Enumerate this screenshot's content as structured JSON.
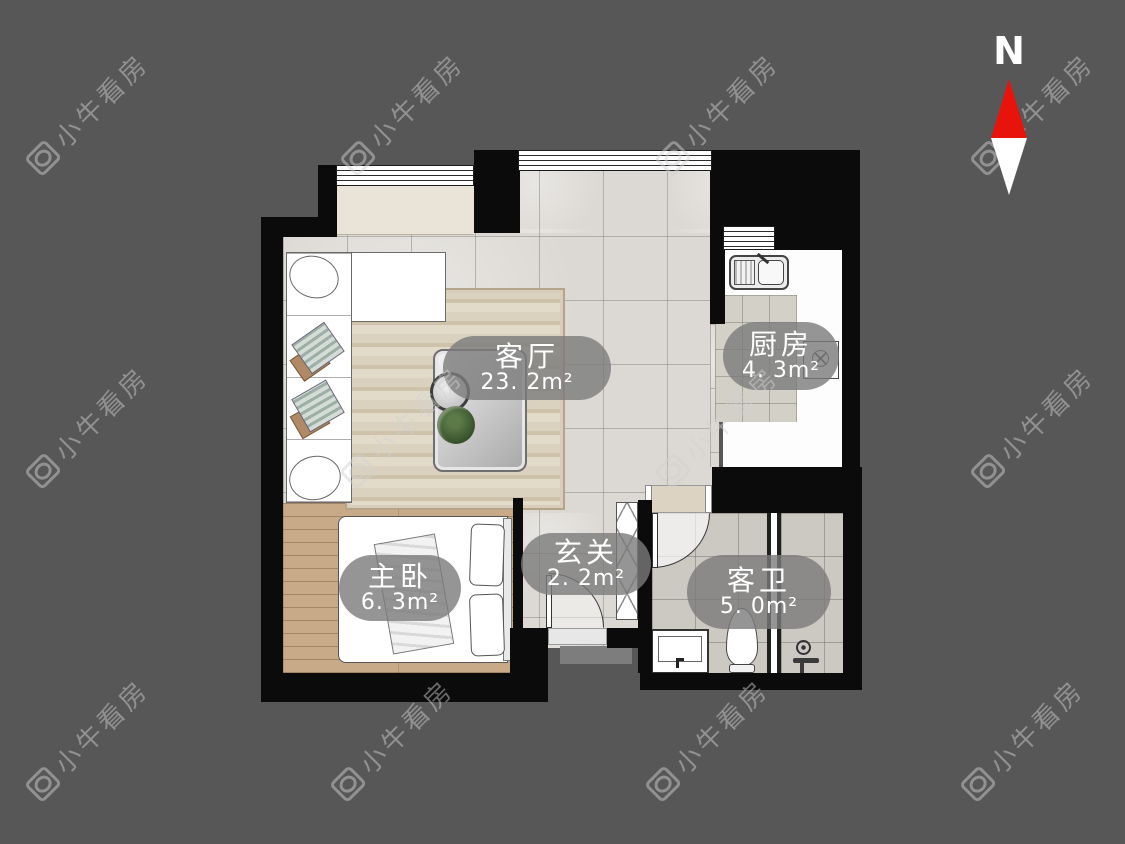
{
  "compass": {
    "north_label": "N"
  },
  "watermark": {
    "text": "小牛看房"
  },
  "rooms": [
    {
      "id": "living-room",
      "name": "客厅",
      "area": "23. 2m²"
    },
    {
      "id": "kitchen",
      "name": "厨房",
      "area": "4. 3m²"
    },
    {
      "id": "entry",
      "name": "玄关",
      "area": "2. 2m²"
    },
    {
      "id": "master-bedroom",
      "name": "主卧",
      "area": "6. 3m²"
    },
    {
      "id": "bathroom",
      "name": "客卫",
      "area": "5. 0m²"
    }
  ],
  "colors": {
    "background": "#575757",
    "wall": "#0b0b0b",
    "label_bubble": "#7b7b7b",
    "label_text": "#ffffff",
    "compass_red": "#e8140c"
  }
}
